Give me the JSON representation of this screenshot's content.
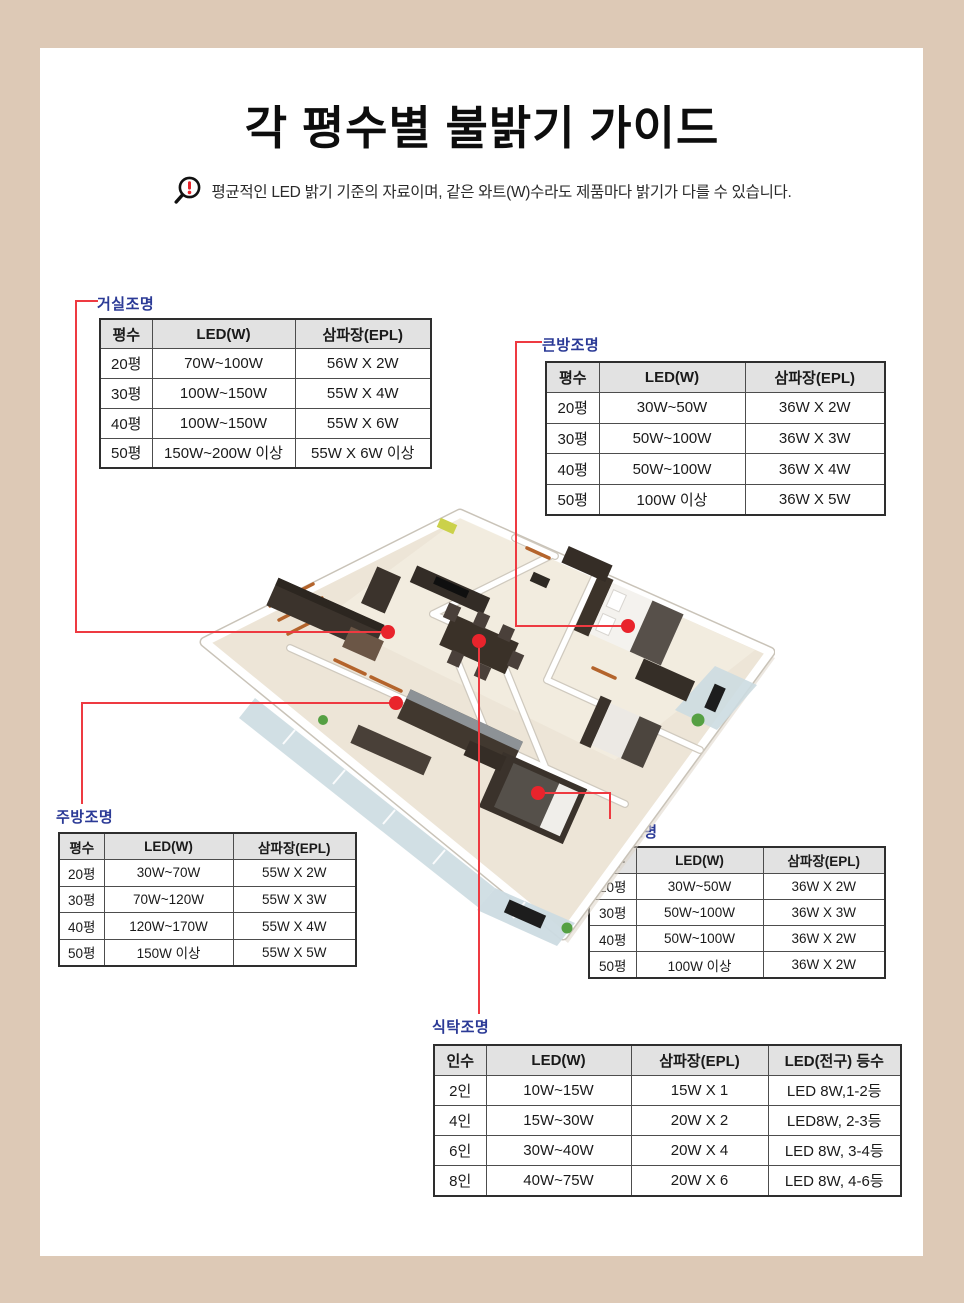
{
  "frame": {
    "background": "#ddc9b6",
    "panel": "#ffffff"
  },
  "header": {
    "title": "각 평수별 불밝기 가이드",
    "note": "평균적인 LED 밝기 기준의 자료이며, 같은 와트(W)수라도 제품마다 밝기가 다를 수 있습니다.",
    "note_icon": "magnifier-exclamation-icon"
  },
  "colors": {
    "label_blue": "#2b3a96",
    "connector_red": "#ee3a41",
    "dot_red": "#e9242c",
    "header_gray": "#e2e2e2",
    "border_tan": "#ddc9b6"
  },
  "tables": {
    "living": {
      "label": "거실조명",
      "headers": [
        "평수",
        "LED(W)",
        "삼파장(EPL)"
      ],
      "rows": [
        [
          "20평",
          "70W~100W",
          "56W X 2W"
        ],
        [
          "30평",
          "100W~150W",
          "55W X 4W"
        ],
        [
          "40평",
          "100W~150W",
          "55W X 6W"
        ],
        [
          "50평",
          "150W~200W 이상",
          "55W X 6W 이상"
        ]
      ]
    },
    "bigroom": {
      "label": "큰방조명",
      "headers": [
        "평수",
        "LED(W)",
        "삼파장(EPL)"
      ],
      "rows": [
        [
          "20평",
          "30W~50W",
          "36W X 2W"
        ],
        [
          "30평",
          "50W~100W",
          "36W X 3W"
        ],
        [
          "40평",
          "50W~100W",
          "36W X 4W"
        ],
        [
          "50평",
          "100W 이상",
          "36W X 5W"
        ]
      ]
    },
    "kitchen": {
      "label": "주방조명",
      "headers": [
        "평수",
        "LED(W)",
        "삼파장(EPL)"
      ],
      "rows": [
        [
          "20평",
          "30W~70W",
          "55W X 2W"
        ],
        [
          "30평",
          "70W~120W",
          "55W X 3W"
        ],
        [
          "40평",
          "120W~170W",
          "55W X 4W"
        ],
        [
          "50평",
          "150W 이상",
          "55W X 5W"
        ]
      ]
    },
    "smallroom": {
      "label": "작은방조명",
      "headers": [
        "평수",
        "LED(W)",
        "삼파장(EPL)"
      ],
      "rows": [
        [
          "20평",
          "30W~50W",
          "36W X 2W"
        ],
        [
          "30평",
          "50W~100W",
          "36W X 3W"
        ],
        [
          "40평",
          "50W~100W",
          "36W X 2W"
        ],
        [
          "50평",
          "100W 이상",
          "36W X 2W"
        ]
      ]
    },
    "dining": {
      "label": "식탁조명",
      "headers": [
        "인수",
        "LED(W)",
        "삼파장(EPL)",
        "LED(전구) 등수"
      ],
      "rows": [
        [
          "2인",
          "10W~15W",
          "15W X 1",
          "LED 8W,1-2등"
        ],
        [
          "4인",
          "15W~30W",
          "20W X 2",
          "LED8W, 2-3등"
        ],
        [
          "6인",
          "30W~40W",
          "20W X 4",
          "LED 8W, 3-4등"
        ],
        [
          "8인",
          "40W~75W",
          "20W X 6",
          "LED 8W, 4-6등"
        ]
      ]
    }
  }
}
